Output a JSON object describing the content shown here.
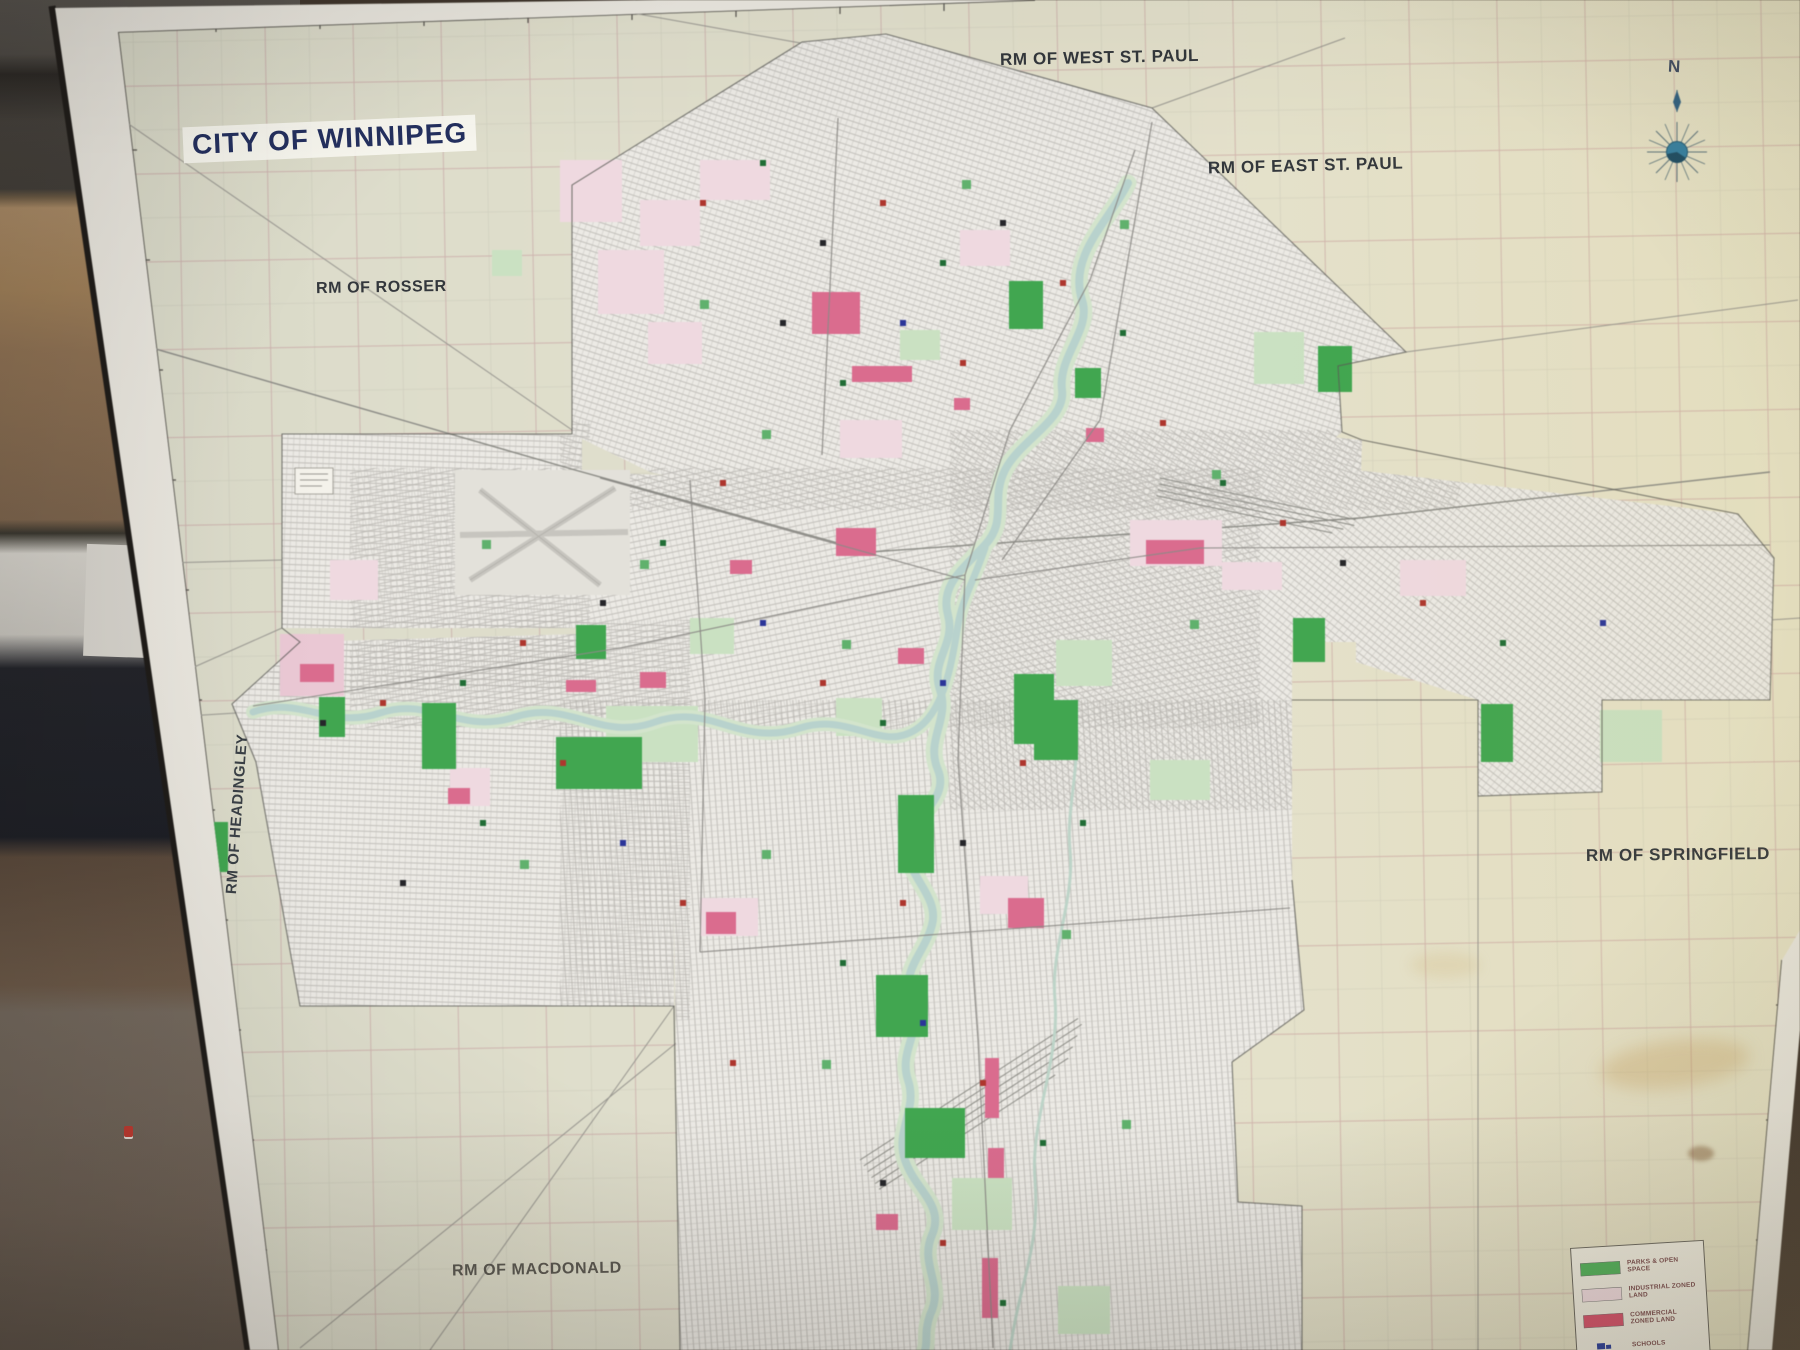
{
  "map_title": "CITY OF WINNIPEG",
  "compass": {
    "north_label": "N"
  },
  "regions": {
    "west_st_paul": "RM OF WEST ST. PAUL",
    "east_st_paul": "RM OF EAST ST. PAUL",
    "rosser": "RM OF ROSSER",
    "headingley": "RM OF HEADINGLEY",
    "springfield": "RM OF SPRINGFIELD",
    "macdonald": "RM OF MACDONALD"
  },
  "legend": {
    "items": [
      {
        "label": "PARKS & OPEN SPACE",
        "color": "#53b45e"
      },
      {
        "label": "INDUSTRIAL ZONED LAND",
        "color": "#f2dde3"
      },
      {
        "label": "COMMERCIAL ZONED LAND",
        "color": "#d9536f"
      },
      {
        "label": "SCHOOLS",
        "color": "#2b3f9e"
      }
    ]
  },
  "colors": {
    "map_sheet": "#e0decb",
    "city_fill": "#ebe9e4",
    "river": "#b7d2cd",
    "parks_green": "#3ba84c",
    "industrial_pink": "#f2dde3",
    "commercial_pink": "#d9536f",
    "title_blue": "#232f5e",
    "compass_blue": "#2d7fa6"
  }
}
